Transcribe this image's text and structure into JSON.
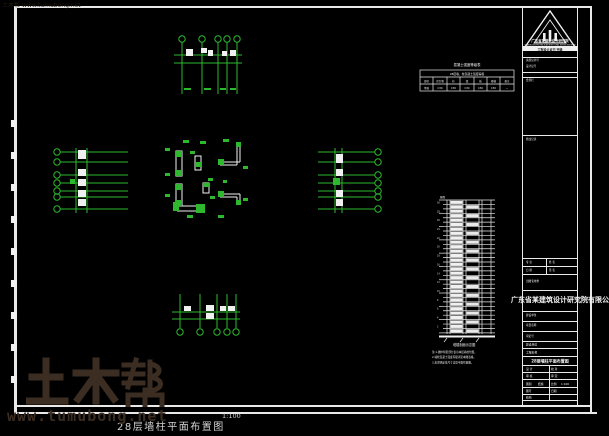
{
  "meta": {
    "background": "#000000",
    "line_green": "#2eb82e",
    "frame_white": "#e9e9e9",
    "watermark_brown": "#3b2d21",
    "corner_watermark": "土木帮 www.tumubong.net"
  },
  "caption": {
    "title": "28层墙柱平面布置图",
    "scale": "1:100"
  },
  "watermark": {
    "brand": "土木帮",
    "url": "www.tumubong.net"
  },
  "title_block": {
    "company": "广东省某建筑设计研究院",
    "company_en": "GUANGDONG PROVINCE ARCHITECTURAL DESIGN INSTITUTE",
    "cert_bar": "工程设计证书 甲级",
    "stamp": "广东省某建筑设计研究院有限公司",
    "drawing_title": "28层墙柱平面布置图",
    "section_labels": [
      "资质证书号",
      "设计证号",
      "会签栏",
      "修改记录",
      "专 业",
      "姓 名",
      "日 期",
      "签 名",
      "出图专用章",
      "建设单位",
      "项目名称",
      "审定号"
    ],
    "field_cells": [
      "建设单位",
      "工程名称",
      "设 计",
      "校 对",
      "审 核",
      "审 定",
      "图别",
      "结施",
      "比例",
      "1:100",
      "图号",
      "日期",
      "结构"
    ]
  },
  "mini_table": {
    "title": "混凝土强度等级表",
    "header": "28层墙、柱混凝土强度等级",
    "rows": [
      [
        "部位",
        "剪力墙",
        "柱",
        "梁",
        "板",
        "楼梯",
        "备注"
      ],
      [
        "等级",
        "C30",
        "C30",
        "C30",
        "C30",
        "C30",
        "—"
      ]
    ]
  },
  "elevation": {
    "floors": 30,
    "top_label": "屋面",
    "label": "塔楼剖面示意图",
    "notes": [
      "注:1.图中阴影部分表示本层墙柱位置。",
      "2.墙柱混凝土强度等级详见本图表格。",
      "3.未注明定位尺寸详见平面布置图。"
    ]
  }
}
